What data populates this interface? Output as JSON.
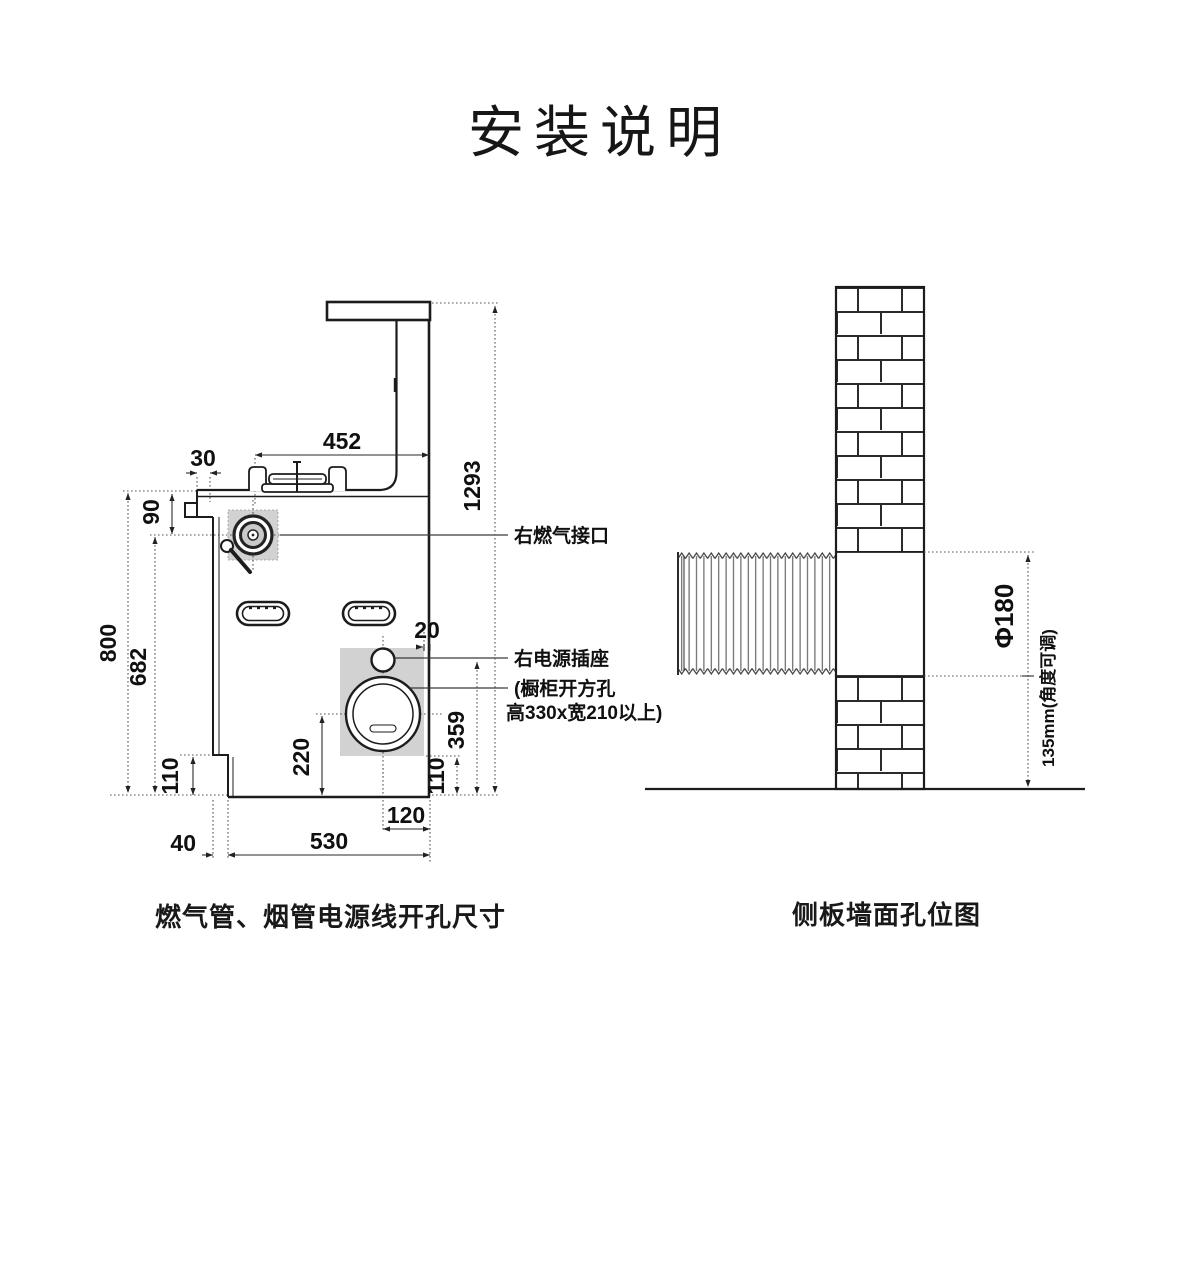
{
  "title": "安装说明",
  "left": {
    "caption": "燃气管、烟管电源线开孔尺寸",
    "labels": {
      "gas": "右燃气接口",
      "socket": "右电源插座",
      "cabinet_line1": "(橱柜开方孔",
      "cabinet_line2": "高330x宽210以上)"
    },
    "dims": {
      "hob_width": "452",
      "top_offset": "30",
      "total_height": "1293",
      "counter_to_gas": "90",
      "height_800": "800",
      "height_682": "682",
      "left_step_height": "110",
      "left_step_width": "40",
      "body_width": "530",
      "duct_to_bottom": "220",
      "duct_to_right": "120",
      "right_step_height": "110",
      "socket_to_bottom": "359",
      "edge_gap": "20"
    }
  },
  "right": {
    "caption": "侧板墙面孔位图",
    "dims": {
      "hole_diameter": "Φ180",
      "adjustable_len": "135mm(角度可调)"
    }
  }
}
